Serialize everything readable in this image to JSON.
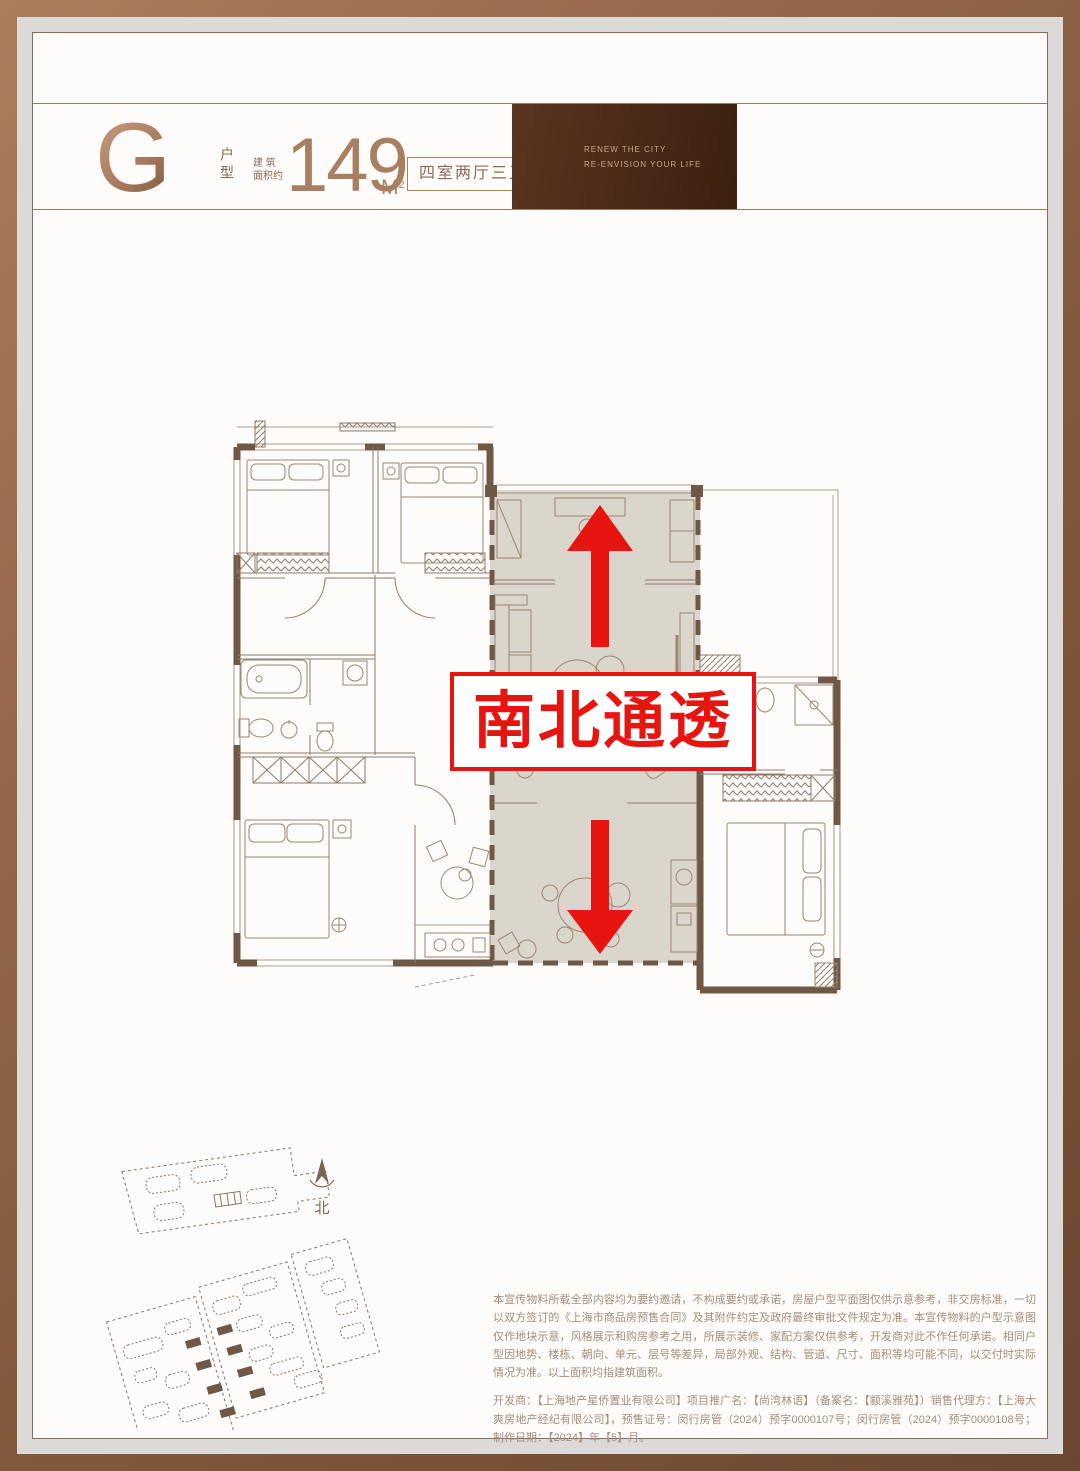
{
  "header": {
    "unit_letter": "G",
    "unit_type_label": "户型",
    "area_prefix_line1": "建 筑",
    "area_prefix_line2": "面积约",
    "area_value": "149",
    "area_unit": "M",
    "area_unit_exponent": "2",
    "layout_tag": "四室两厅三卫",
    "photo_tagline_line1": "RENEW THE CITY",
    "photo_tagline_line2": "RE-ENVISION YOUR LIFE"
  },
  "floor_plan": {
    "highlight_banner": "南北通透",
    "compass_label": "北"
  },
  "disclaimer": {
    "paragraph1": "本宣传物料所载全部内容均为要约邀请，不构成要约或承诺，房屋户型平面图仅供示意参考，非交房标准，一切以双方签订的《上海市商品房预售合同》及其附件约定及政府最终审批文件规定为准。本宣传物料的户型示意图仅作地块示意，风格展示和购房参考之用，所展示装修、家配方案仅供参考，开发商对此不作任何承诺。相同户型因地势、楼栋、朝向、单元、层号等差异，局部外观、结构、管道、尺寸、面积等均可能不同，以交付时实际情况为准。以上面积均指建筑面积。",
    "paragraph2": "开发商：【上海地产星侨置业有限公司】项目推广名：【尚湾林语】（备案名：【颛溪雅苑】）销售代理方：【上海大爽房地产经纪有限公司】，预售证号：闵行房管（2024）预字0000107号；闵行房管（2024）预字0000108号；制作日期：【2024】年【5】月。"
  },
  "colors": {
    "accent_red": "#e81410",
    "bronze_text": "#a87f60",
    "frame_bronze_light": "#ab7d5b",
    "frame_bronze_dark": "#6b4730",
    "photo_panel_brown": "#4a2917",
    "plan_line": "#8f7a69",
    "plan_wall": "#6f5846",
    "plan_highlight_fill": "#d8d2c8",
    "disclaimer_text": "#a58d79"
  }
}
